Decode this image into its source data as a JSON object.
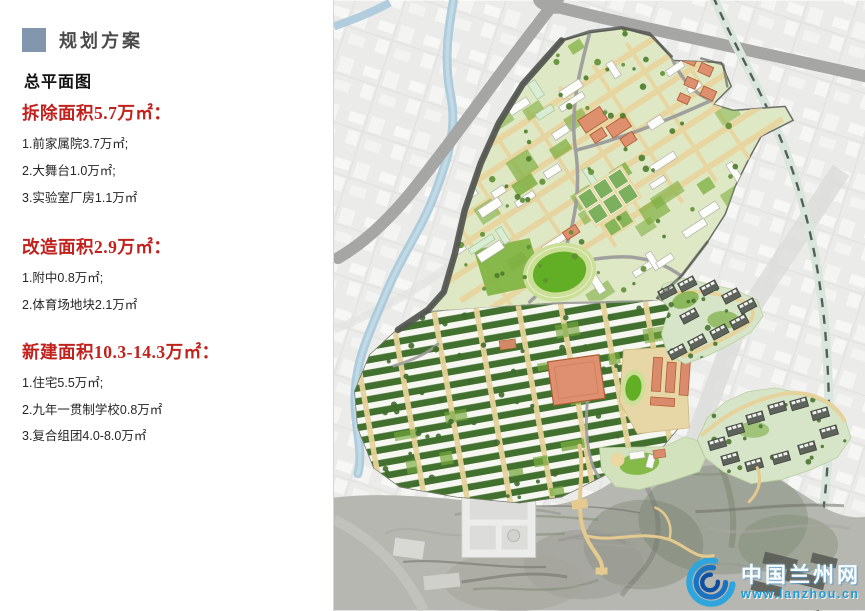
{
  "panel": {
    "title": "规划方案",
    "subtitle": "总平面图",
    "sections": [
      {
        "heading": "拆除面积5.7万㎡：",
        "items": [
          "1.前家属院3.7万㎡;",
          "2.大舞台1.0万㎡;",
          "3.实验室厂房1.1万㎡"
        ]
      },
      {
        "heading": "改造面积2.9万㎡：",
        "items": [
          "1.附中0.8万㎡;",
          "2.体育场地块2.1万㎡"
        ]
      },
      {
        "heading": "新建面积10.3-14.3万㎡：",
        "items": [
          "1.住宅5.5万㎡;",
          "2.九年一贯制学校0.8万㎡",
          "3.复合组团4.0-8.0万㎡"
        ]
      }
    ]
  },
  "map": {
    "logo": {
      "site_name": "中国兰州网",
      "site_url": "www.lanzhou.cn"
    }
  },
  "colors": {
    "header_square": "#8297ae",
    "heading_red": "#c1221e",
    "logo_blue": "#1e9ad6",
    "campus_green": "#7cae3f",
    "road_tan": "#e6d39c",
    "building_salmon": "#de9070",
    "tower_dark": "#5e635b",
    "river_blue": "#a9c9da"
  }
}
